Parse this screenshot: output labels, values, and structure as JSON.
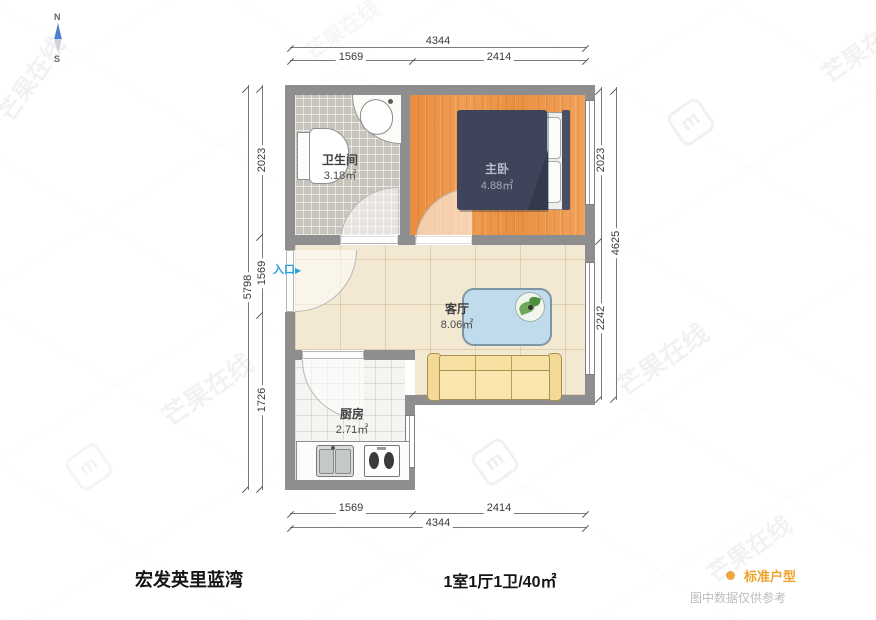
{
  "compass": {
    "north": "N",
    "south": "S"
  },
  "watermark": {
    "text": "芒果在线",
    "logo_glyph": "m"
  },
  "plan": {
    "entrance_label": "入口",
    "entrance_arrow": "▶",
    "rooms": [
      {
        "id": "bathroom",
        "name": "卫生间",
        "area": "3.18㎡"
      },
      {
        "id": "bedroom",
        "name": "主卧",
        "area": "4.88㎡"
      },
      {
        "id": "living",
        "name": "客厅",
        "area": "8.06㎡"
      },
      {
        "id": "kitchen",
        "name": "厨房",
        "area": "2.71㎡"
      }
    ],
    "dimensions": {
      "top": {
        "total": "4344",
        "segments": [
          "1569",
          "2414"
        ]
      },
      "bottom": {
        "total": "4344",
        "segments": [
          "1569",
          "2414"
        ]
      },
      "left": {
        "total": "5798",
        "segments": [
          "2023",
          "1569",
          "1726"
        ]
      },
      "right": {
        "total": "4625",
        "segments": [
          "2023",
          "2242"
        ]
      }
    }
  },
  "footer": {
    "property_name": "宏发英里蓝湾",
    "layout_summary": "1室1厅1卫/40㎡",
    "legend_label": "标准户型",
    "disclaimer": "图中数据仅供参考",
    "accent_color": "#F2A93B"
  }
}
